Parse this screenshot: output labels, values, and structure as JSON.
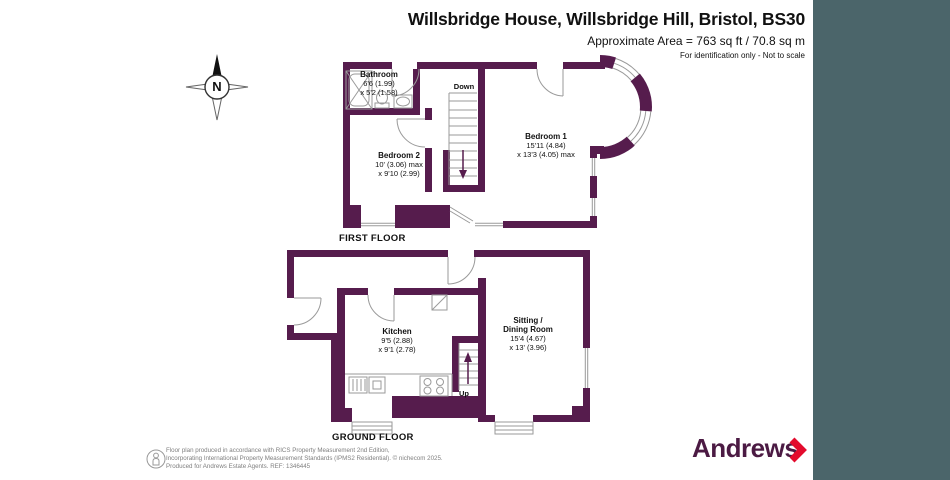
{
  "header": {
    "title": "Willsbridge House, Willsbridge Hill, Bristol, BS30",
    "area": "Approximate Area = 763 sq ft / 70.8 sq m",
    "note": "For identification only - Not to scale"
  },
  "compass": {
    "label": "N"
  },
  "floors": {
    "first": {
      "caption": "FIRST FLOOR",
      "stairs_label": "Down",
      "rooms": [
        {
          "name": "Bathroom",
          "dim1": "6'6 (1.99)",
          "dim2": "x 5'2 (1.58)"
        },
        {
          "name": "Bedroom 2",
          "dim1": "10' (3.06) max",
          "dim2": "x 9'10 (2.99)"
        },
        {
          "name": "Bedroom 1",
          "dim1": "15'11 (4.84)",
          "dim2": "x 13'3 (4.05) max"
        }
      ]
    },
    "ground": {
      "caption": "GROUND FLOOR",
      "stairs_label": "Up",
      "rooms": [
        {
          "name": "Kitchen",
          "dim1": "9'5 (2.88)",
          "dim2": "x 9'1 (2.78)"
        },
        {
          "name": "Sitting /",
          "name2": "Dining Room",
          "dim1": "15'4 (4.67)",
          "dim2": "x 13' (3.96)"
        }
      ]
    }
  },
  "footer": {
    "line1": "Floor plan produced in accordance with RICS Property Measurement 2nd Edition,",
    "line2": "Incorporating International Property Measurement Standards (IPMS2 Residential).  © nichecom 2025.",
    "line3": "Produced for Andrews Estate Agents.   REF: 1346445",
    "brand": "Andrews"
  },
  "colors": {
    "wall": "#561c4d",
    "panel_teal": "#4b656a",
    "brand_purple": "#4b1a43",
    "brand_red": "#e30b2d"
  }
}
